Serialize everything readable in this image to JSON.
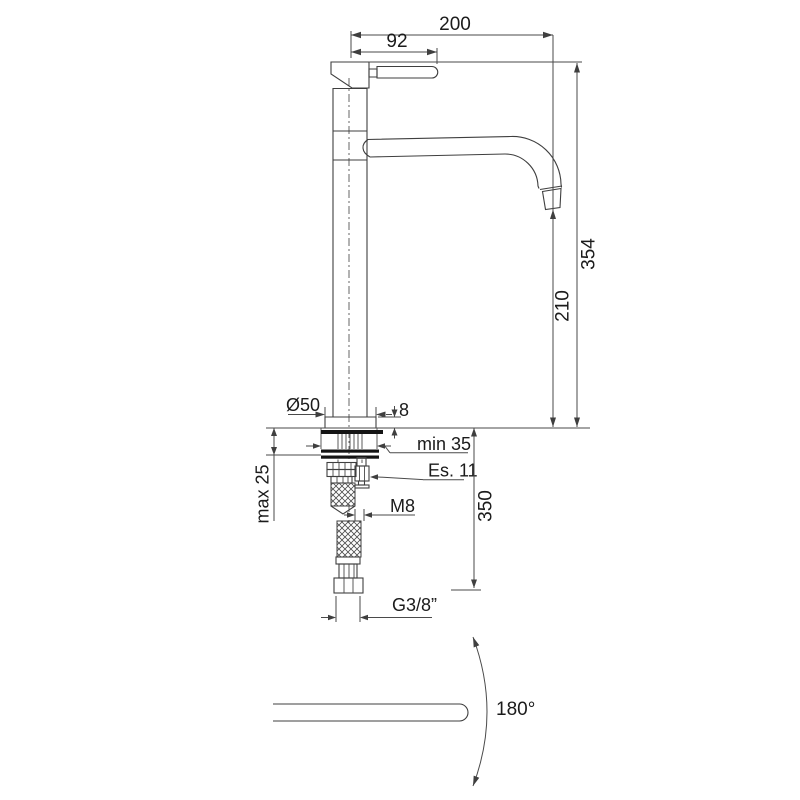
{
  "drawing": {
    "type": "tall single-lever basin mixer tap - dimensional technical drawing",
    "line_color": "#3f3f3f",
    "text_color": "#1b1b1b",
    "background_color": "#ffffff",
    "dims_top": {
      "spout_reach": "200",
      "handle_length": "92"
    },
    "dims_right": {
      "total_height": "354",
      "spout_height": "210"
    },
    "dims_base": {
      "base_diameter": "Ø50",
      "base_plate_height": "8",
      "mounting_hole_min": "min 35",
      "hex_key": "Es. 11",
      "deck_thickness_max": "max 25",
      "supply_hose_length": "350",
      "stud_thread": "M8",
      "hose_thread": "G3/8”"
    },
    "dims_bottom": {
      "swivel_angle": "180°"
    }
  }
}
